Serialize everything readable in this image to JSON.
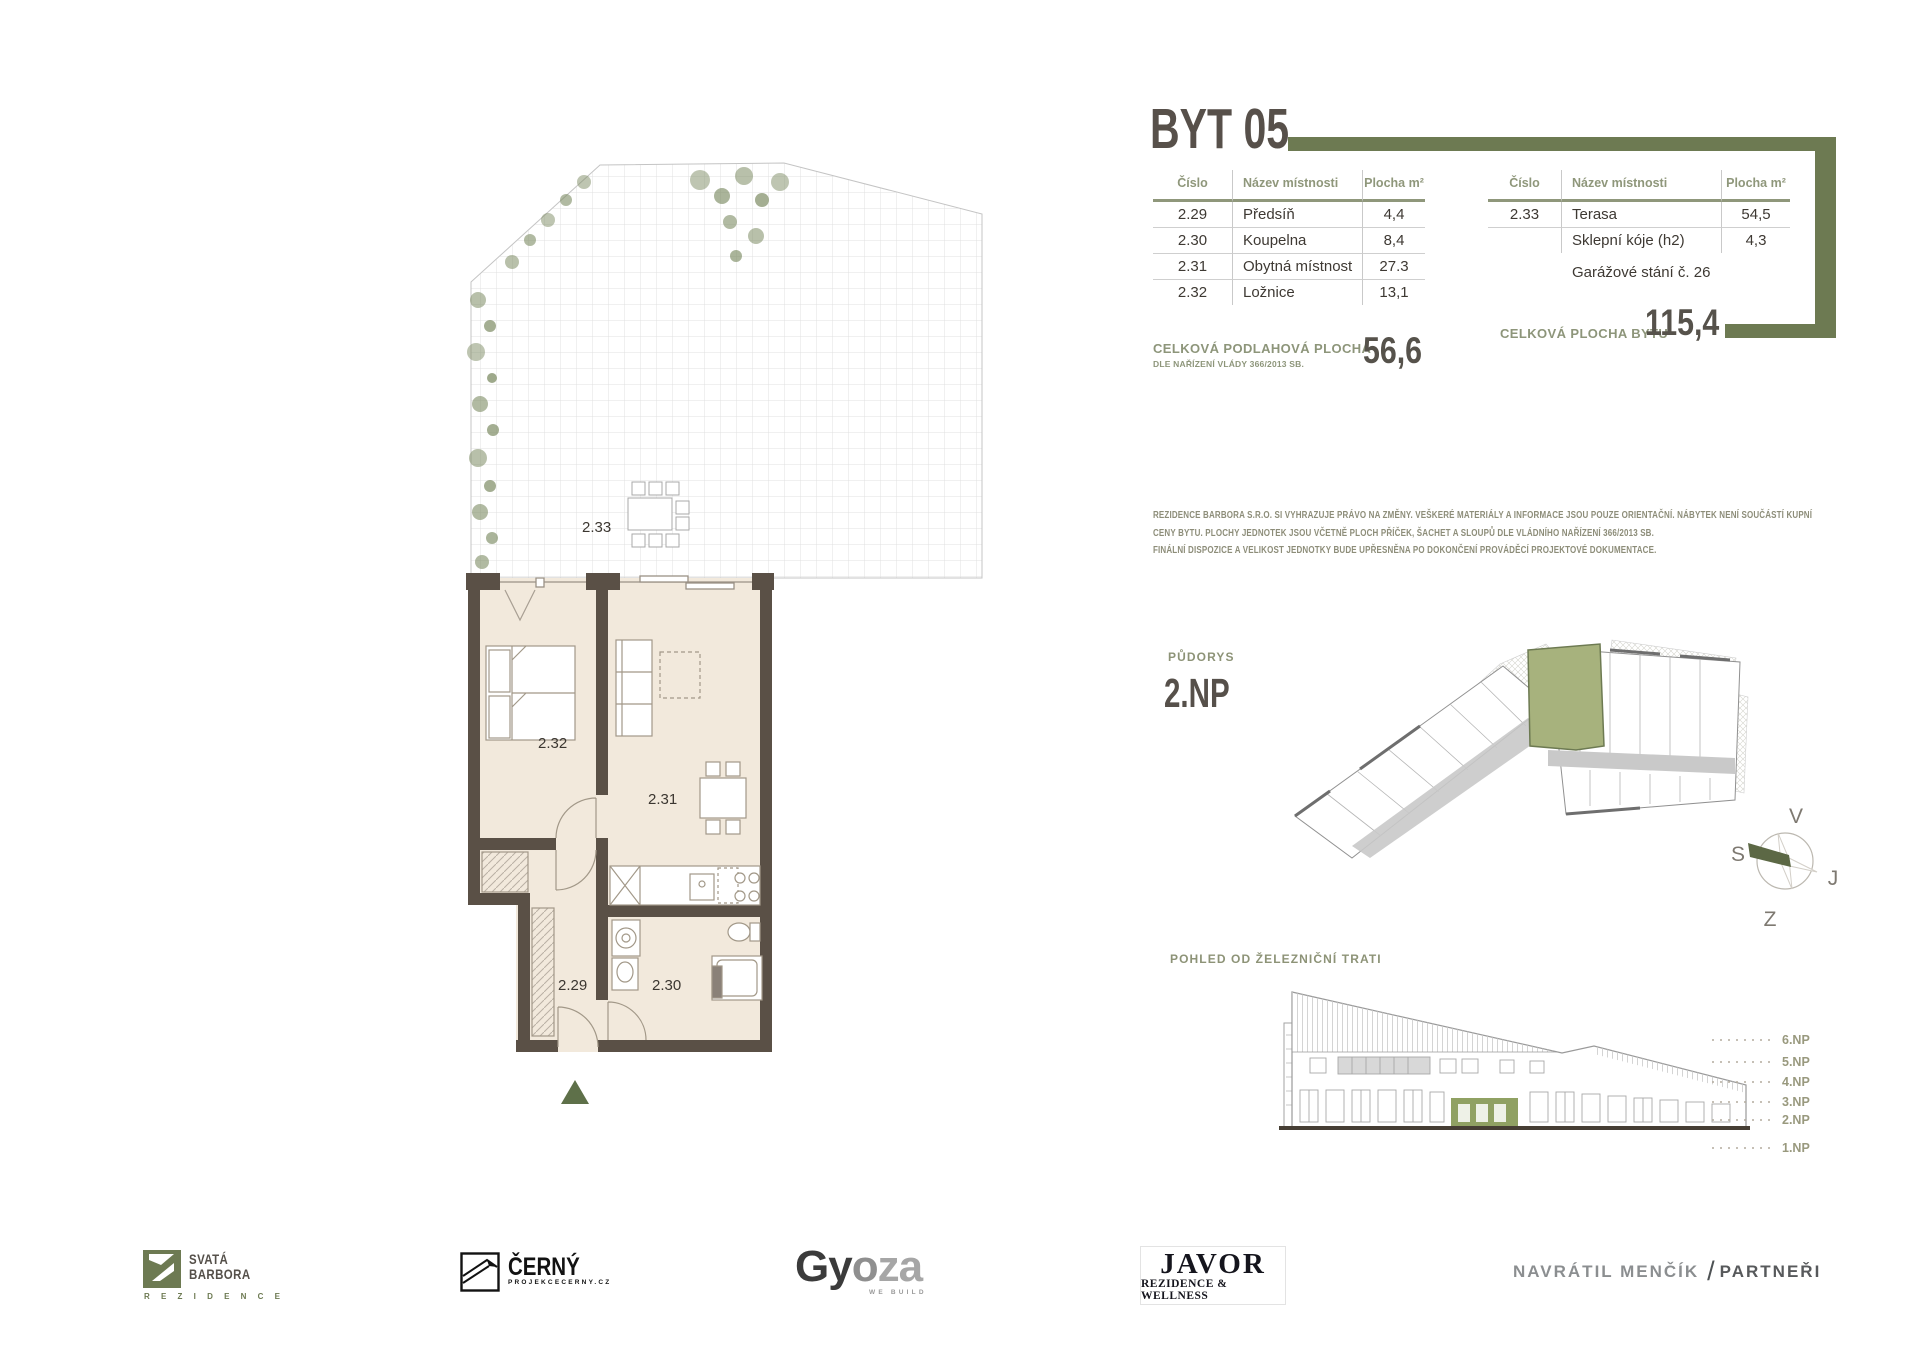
{
  "document": {
    "title": "BYT 05"
  },
  "tables": {
    "headers": {
      "num": "Číslo",
      "name": "Název místnosti",
      "area": "Plocha m²"
    },
    "left": {
      "rows": [
        {
          "num": "2.29",
          "name": "Předsíň",
          "area": "4,4"
        },
        {
          "num": "2.30",
          "name": "Koupelna",
          "area": "8,4"
        },
        {
          "num": "2.31",
          "name": "Obytná místnost",
          "area": "27.3"
        },
        {
          "num": "2.32",
          "name": "Ložnice",
          "area": "13,1"
        }
      ]
    },
    "right": {
      "rows": [
        {
          "num": "2.33",
          "name": "Terasa",
          "area": "54,5"
        },
        {
          "num": "",
          "name": "Sklepní kóje (h2)",
          "area": "4,3"
        }
      ],
      "note": "Garážové stání č. 26"
    }
  },
  "totals": {
    "floor_area_label": "CELKOVÁ PODLAHOVÁ PLOCHA",
    "floor_area_sublabel": "DLE NAŘÍZENÍ VLÁDY 366/2013 SB.",
    "floor_area_value": "56,6",
    "total_area_label": "CELKOVÁ PLOCHA BYTU",
    "total_area_value": "115,4"
  },
  "disclaimer": {
    "line1": "REZIDENCE BARBORA S.R.O. SI VYHRAZUJE PRÁVO NA ZMĚNY. VEŠKERÉ MATERIÁLY A INFORMACE JSOU POUZE ORIENTAČNÍ. NÁBYTEK NENÍ SOUČÁSTÍ KUPNÍ",
    "line2": "CENY BYTU. PLOCHY JEDNOTEK JSOU VČETNĚ PLOCH PŘÍČEK, ŠACHET A SLOUPŮ DLE VLÁDNÍHO NAŘÍZENÍ 366/2013 SB.",
    "line3": "FINÁLNÍ DISPOZICE A VELIKOST JEDNOTKY BUDE UPŘESNĚNA PO DOKONČENÍ PROVÁDĚCÍ PROJEKTOVÉ DOKUMENTACE."
  },
  "floorplan": {
    "terrace": "2.33",
    "bedroom": "2.32",
    "living": "2.31",
    "hall": "2.29",
    "bath": "2.30"
  },
  "overview": {
    "label": "PŮDORYS",
    "floor": "2.NP"
  },
  "compass": {
    "top": "V",
    "left": "S",
    "right": "J",
    "bottom": "Z"
  },
  "elevation": {
    "label": "POHLED OD ŽELEZNIČNÍ TRATI",
    "floors": [
      "6.NP",
      "5.NP",
      "4.NP",
      "3.NP",
      "2.NP",
      "1.NP"
    ]
  },
  "footer": {
    "barbora": {
      "line1": "SVATÁ",
      "line2": "BARBORA",
      "sub": "R E Z I D E N C E"
    },
    "cerny": {
      "name": "ČERNÝ",
      "sub": "PROJEKCECERNY.CZ"
    },
    "gyoza": {
      "p1": "Gy",
      "p2": "o",
      "p3": "za",
      "sub": "WE BUILD"
    },
    "javor": {
      "name": "JAVOR",
      "sub": "REZIDENCE & WELLNESS"
    },
    "navratil": {
      "p1": "NAVRÁTIL MENČÍK",
      "slash": "/",
      "p2": "PARTNEŘI"
    }
  },
  "colors": {
    "accent_olive": "#6d7a52",
    "title_brown": "#57504a",
    "wall_brown": "#5a5046",
    "floor_beige": "#f2e9dc",
    "unit_green": "#a7b27d",
    "entry_arrow_green": "#5e7049"
  }
}
